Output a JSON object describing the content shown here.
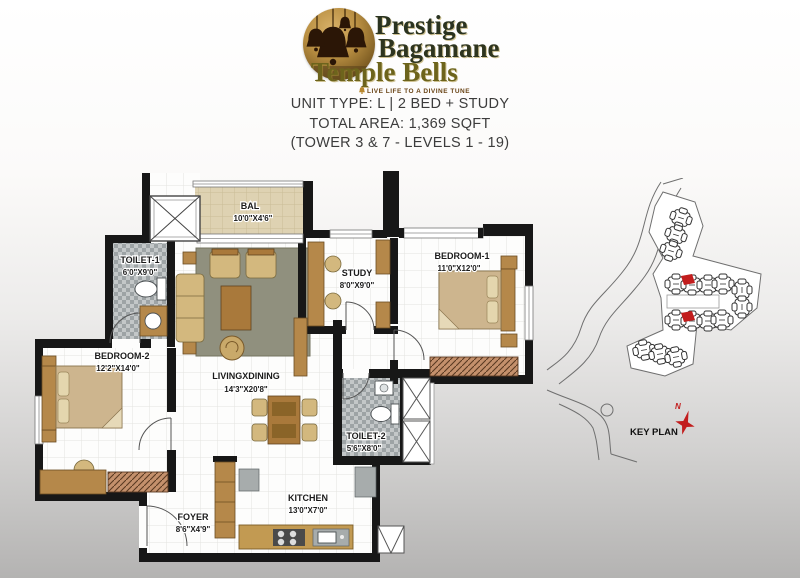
{
  "logo": {
    "brand_line1": "Prestige",
    "brand_line2": "Bagamane",
    "brand_line3": "Temple Bells",
    "tagline": "LIVE LIFE TO A DIVINE TUNE"
  },
  "unit_info": {
    "unit_type": "UNIT TYPE: L | 2 BED + STUDY",
    "total_area": "TOTAL AREA: 1,369 SQFT",
    "tower_levels": "(TOWER 3 & 7 - LEVELS 1 - 19)"
  },
  "floor_plan": {
    "rooms": {
      "bal": {
        "name": "BAL",
        "dims": "10'0\"X4'6\""
      },
      "toilet1": {
        "name": "TOILET-1",
        "dims": "6'0\"X9'0\""
      },
      "study": {
        "name": "STUDY",
        "dims": "8'0\"X9'0\""
      },
      "bedroom1": {
        "name": "BEDROOM-1",
        "dims": "11'0\"X12'0\""
      },
      "bedroom2": {
        "name": "BEDROOM-2",
        "dims": "12'2\"X14'0\""
      },
      "living": {
        "name": "LIVINGXDINING",
        "dims": "14'3\"X20'8\""
      },
      "toilet2": {
        "name": "TOILET-2",
        "dims": "5'6\"X8'0\""
      },
      "kitchen": {
        "name": "KITCHEN",
        "dims": "13'0\"X7'0\""
      },
      "foyer": {
        "name": "FOYER",
        "dims": "8'6\"X4'9\""
      }
    },
    "colors": {
      "wall": "#171717",
      "wood": "#b5884a",
      "tile_gray": "#a0a6a8",
      "tile_beige": "#ded2b2"
    }
  },
  "key_plan": {
    "label": "KEY PLAN",
    "north_label": "N",
    "highlight_color": "#c21d1d"
  }
}
